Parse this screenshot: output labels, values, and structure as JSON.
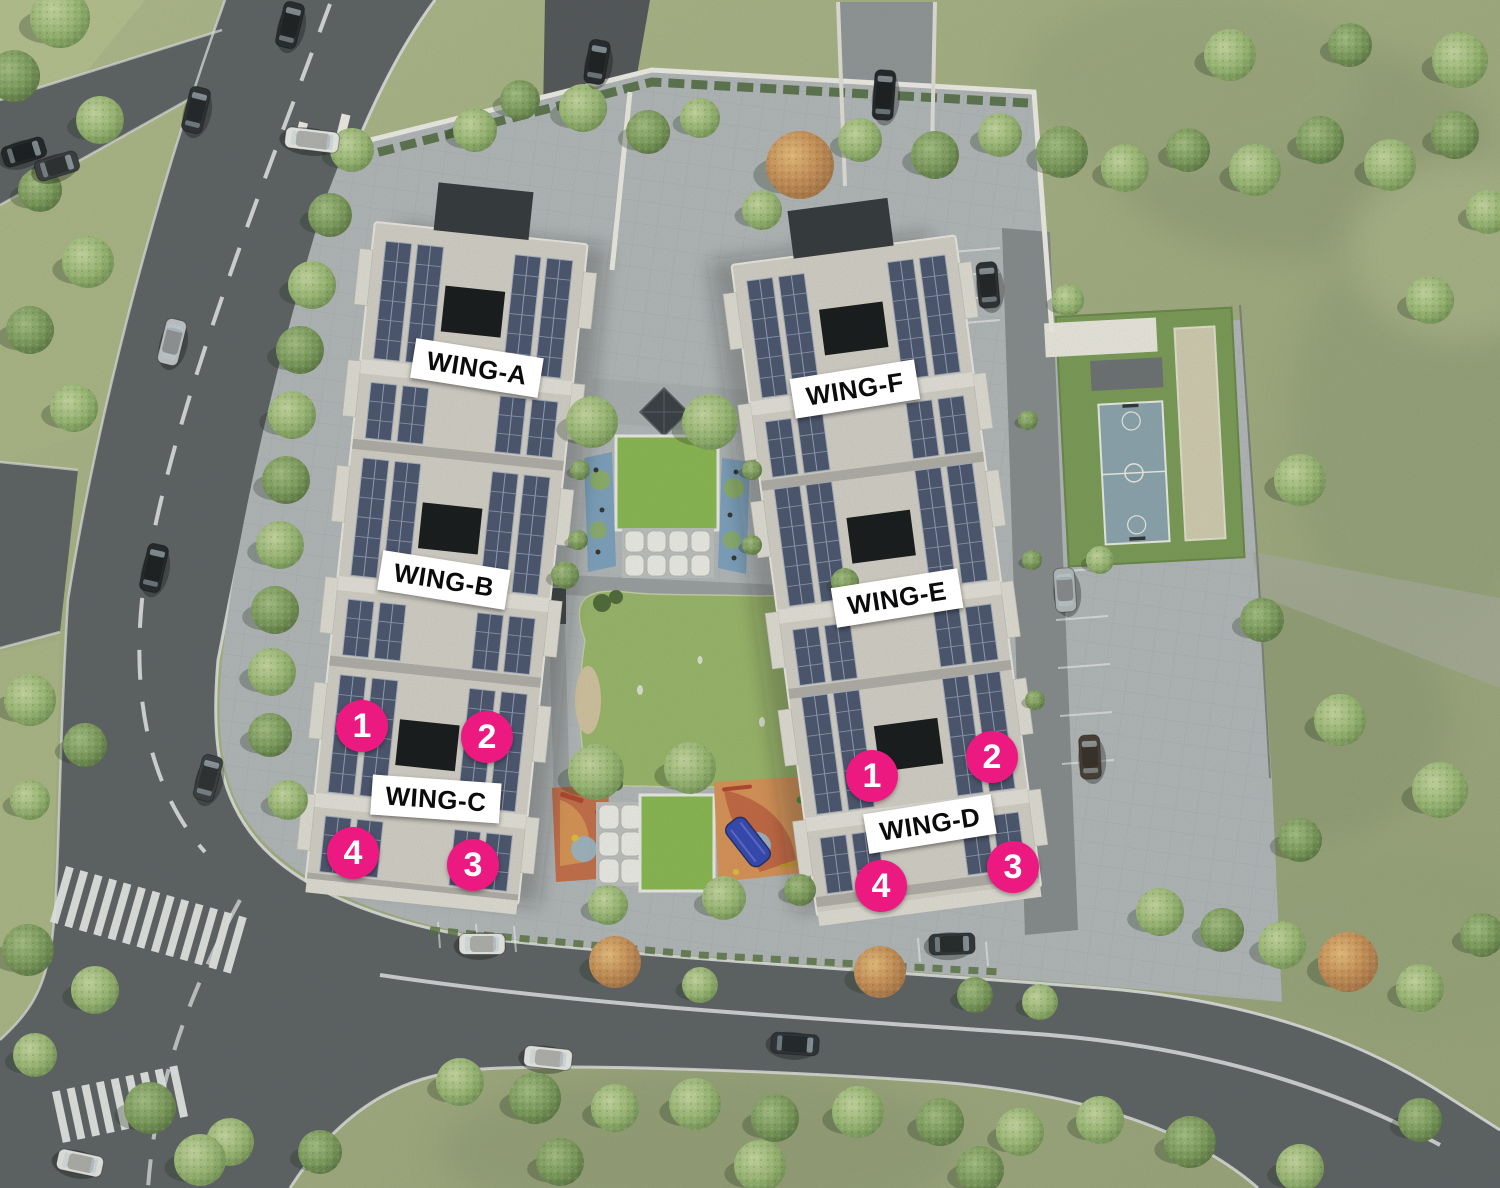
{
  "site_plan": {
    "wings": [
      {
        "name": "WING-A",
        "x": 477,
        "y": 368,
        "rotation": 9
      },
      {
        "name": "WING-B",
        "x": 444,
        "y": 580,
        "rotation": 9
      },
      {
        "name": "WING-C",
        "x": 436,
        "y": 799,
        "rotation": 4
      },
      {
        "name": "WING-D",
        "x": 930,
        "y": 824,
        "rotation": -9
      },
      {
        "name": "WING-E",
        "x": 897,
        "y": 598,
        "rotation": -9
      },
      {
        "name": "WING-F",
        "x": 855,
        "y": 389,
        "rotation": -9
      }
    ],
    "unit_markers": [
      {
        "number": "1",
        "building": "west",
        "x": 362,
        "y": 726
      },
      {
        "number": "2",
        "building": "west",
        "x": 487,
        "y": 737
      },
      {
        "number": "4",
        "building": "west",
        "x": 353,
        "y": 853
      },
      {
        "number": "3",
        "building": "west",
        "x": 473,
        "y": 865
      },
      {
        "number": "1",
        "building": "east",
        "x": 872,
        "y": 776
      },
      {
        "number": "2",
        "building": "east",
        "x": 992,
        "y": 757
      },
      {
        "number": "4",
        "building": "east",
        "x": 881,
        "y": 886
      },
      {
        "number": "3",
        "building": "east",
        "x": 1013,
        "y": 867
      }
    ],
    "colors": {
      "marker_pink": "#EC1A80",
      "marker_text": "#FFFFFF",
      "label_background": "#FFFFFF",
      "label_text": "#0B0B0B",
      "road_asphalt": "#5E6266",
      "pavement": "#B7BBBF",
      "grass": "#A9B286",
      "solar_panel": "#4A5470",
      "building_facade": "#D9D5CD",
      "central_lawn": "#9DBA6C",
      "green_roof": "#8CBC53",
      "sports_court": "#8EA7B3",
      "playground_orange": "#DE9558",
      "playground_red": "#C96F4A",
      "slide_blue": "#3346B8"
    }
  }
}
